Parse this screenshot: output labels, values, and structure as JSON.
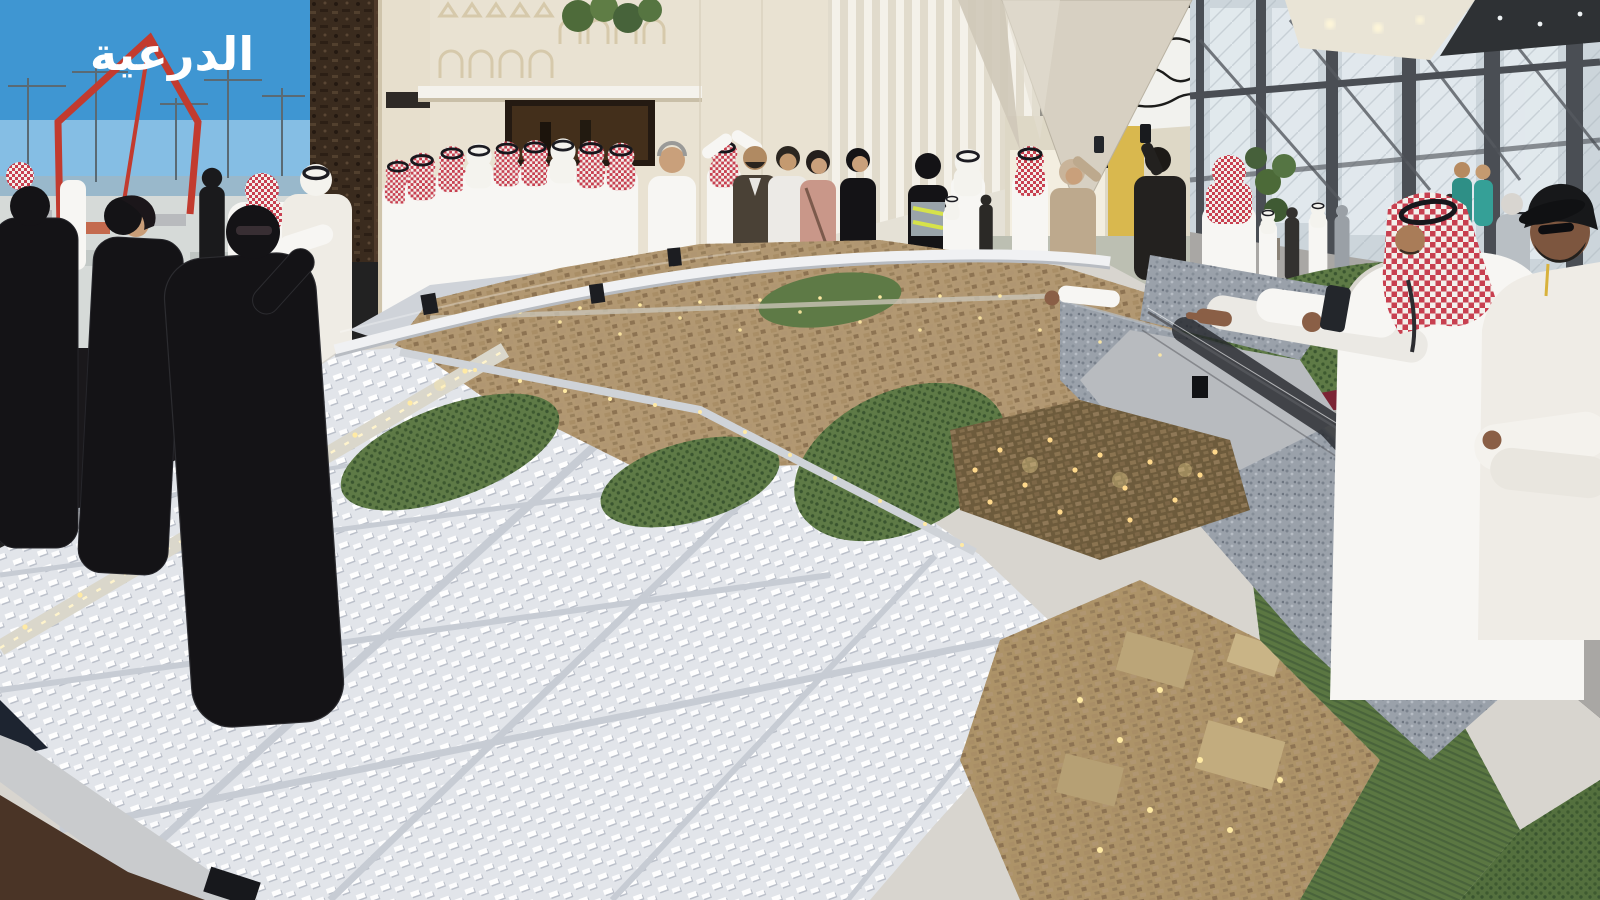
{
  "screen": {
    "arabic_text": "الدرعية"
  },
  "colors": {
    "sky": "#3f96d2",
    "skyLight": "#bfe0f2",
    "wall": "#e9e2d2",
    "wallShade": "#dfd5bf",
    "fin": "#f2efe7",
    "canopy": "#d7d0c2",
    "pillar": "#3a2b1e",
    "craneRed": "#c23b2f",
    "glass": "#ccd5db",
    "glassDark": "#4a4e54",
    "floor": "#a9a7a4",
    "floorBrown": "#4a3426",
    "modelWhite": "#e2e5ea",
    "modelRoad": "#c7ccd4",
    "tan": "#b29872",
    "tanDark": "#8d7352",
    "green": "#5e7a46",
    "greenDark": "#415c33",
    "rock": "#9aa1aa",
    "plateau": "#b8bbbf",
    "gold": "#ffd98c",
    "thobe": "#f7f6f3",
    "shemagh": "#c84050",
    "abaya": "#141316",
    "skin": "#c9a07b",
    "maroon": "#7c2434",
    "booth": "#ded8c6",
    "yellow": "#d9b84e"
  }
}
